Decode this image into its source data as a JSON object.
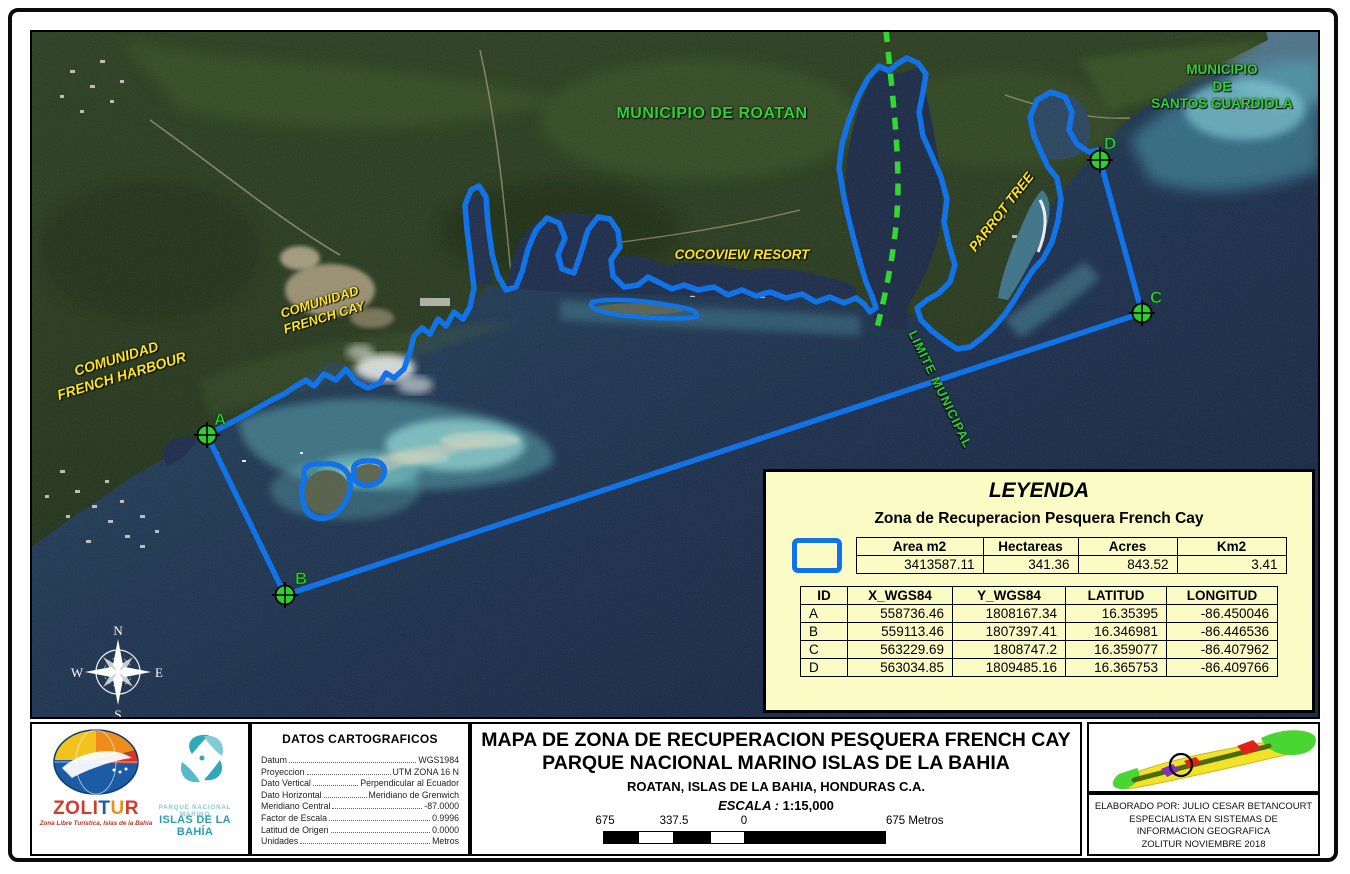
{
  "map": {
    "labels": {
      "municipio_roatan": "MUNICIPIO DE ROATAN",
      "municipio_santos": "MUNICIPIO\nDE\nSANTOS GUARDIOLA",
      "comunidad_french_harbour": "COMUNIDAD\nFRENCH HARBOUR",
      "comunidad_french_cay": "COMUNIDAD\nFRENCH CAY",
      "cocoview": "COCOVIEW RESORT",
      "parrot_tree": "PARROT TREE",
      "limite_municipal": "LIMITE MUNICIPAL"
    },
    "markers": [
      {
        "id": "A"
      },
      {
        "id": "B"
      },
      {
        "id": "C"
      },
      {
        "id": "D"
      }
    ],
    "compass": {
      "n": "N",
      "e": "E",
      "s": "S",
      "w": "W"
    },
    "colors": {
      "zone_boundary": "#1273e8",
      "municipal_line": "#34d634",
      "label_green": "#2fd32f",
      "label_yellow": "#ffe717",
      "legend_bg": "#fbfbc6"
    }
  },
  "legend": {
    "title": "LEYENDA",
    "subtitle": "Zona de Recuperacion Pesquera French Cay",
    "area_table": {
      "headers": [
        "Area m2",
        "Hectareas",
        "Acres",
        "Km2"
      ],
      "row": [
        "3413587.11",
        "341.36",
        "843.52",
        "3.41"
      ]
    },
    "coord_table": {
      "headers": [
        "ID",
        "X_WGS84",
        "Y_WGS84",
        "LATITUD",
        "LONGITUD"
      ],
      "rows": [
        [
          "A",
          "558736.46",
          "1808167.34",
          "16.35395",
          "-86.450046"
        ],
        [
          "B",
          "559113.46",
          "1807397.41",
          "16.346981",
          "-86.446536"
        ],
        [
          "C",
          "563229.69",
          "1808747.2",
          "16.359077",
          "-86.407962"
        ],
        [
          "D",
          "563034.85",
          "1809485.16",
          "16.365753",
          "-86.409766"
        ]
      ]
    }
  },
  "datos": {
    "title": "DATOS CARTOGRAFICOS",
    "rows": [
      {
        "label": "Datum",
        "value": "WGS1984"
      },
      {
        "label": "Proyeccion",
        "value": "UTM ZONA 16 N"
      },
      {
        "label": "Dato Vertical",
        "value": "Perpendicular al Ecuador"
      },
      {
        "label": "Dato Horizontal",
        "value": "Meridiano de Grenwich"
      },
      {
        "label": "Meridiano Central",
        "value": "-87.0000"
      },
      {
        "label": "Factor de Escala",
        "value": "0.9996"
      },
      {
        "label": "Latitud de Origen",
        "value": "0.0000"
      },
      {
        "label": "Unidades",
        "value": "Metros"
      }
    ]
  },
  "title_block": {
    "line1": "MAPA DE ZONA DE RECUPERACION PESQUERA FRENCH CAY",
    "line2": "PARQUE NACIONAL MARINO ISLAS DE LA BAHIA",
    "line3": "ROATAN, ISLAS DE LA BAHIA, HONDURAS C.A.",
    "escala_label": "ESCALA :",
    "escala_value": "1:15,000",
    "scale_ticks": [
      "675",
      "337.5",
      "0",
      "675 Metros"
    ]
  },
  "credits": {
    "lines": [
      "ELABORADO POR: JULIO CESAR BETANCOURT",
      "ESPECIALISTA EN SISTEMAS DE",
      "INFORMACION  GEOGRAFICA",
      "ZOLITUR NOVIEMBRE 2018"
    ]
  },
  "logos": {
    "zolitur": "ZOLITUR",
    "zolitur_tagline": "Zona Libre Turística, Islas de la Bahía",
    "pnmib_line1": "PARQUE NACIONAL MARINO",
    "pnmib_line2": "ISLAS DE LA BAHÍA"
  }
}
